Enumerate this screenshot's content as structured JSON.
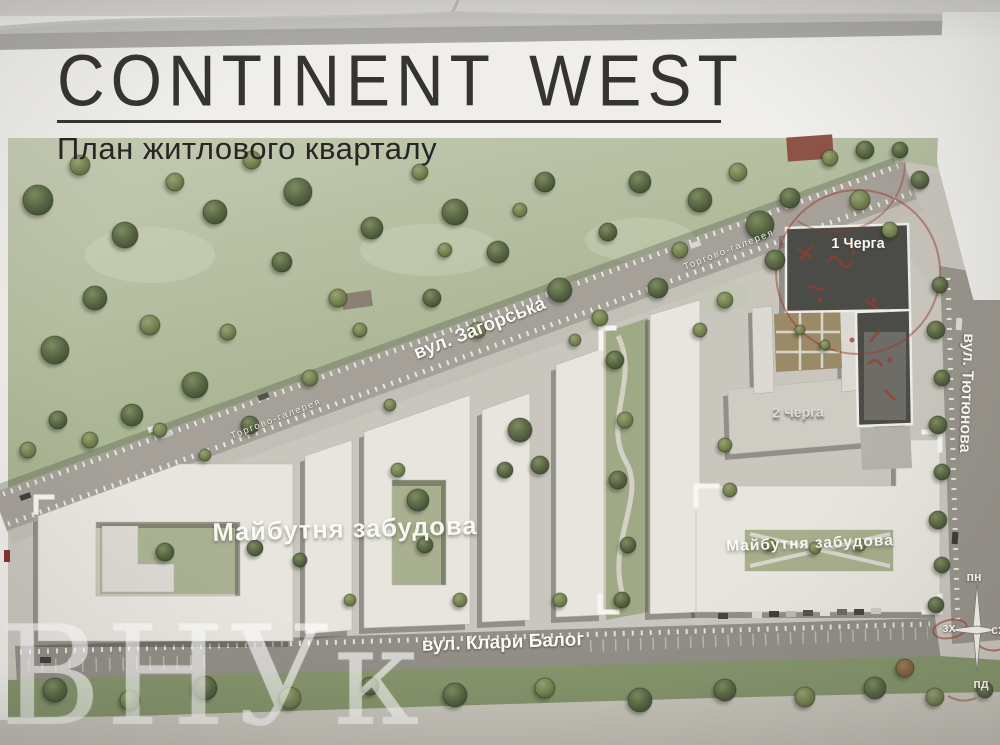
{
  "header": {
    "logo": "CONTINENT WEST",
    "subtitle": "План житлового кварталу"
  },
  "map": {
    "streets": {
      "zahorska": "вул. Загорська",
      "tyutyunova": "вул. Тютюнова",
      "klary_baloh": "вул. Клари Балог"
    },
    "galleries": {
      "first": "Торгово-галерея",
      "second": "Торгово-галерея"
    },
    "phases": {
      "phase1": "1 Черга",
      "phase2": "2 Черга"
    },
    "future": {
      "left": "Майбутня забудова",
      "right": "Майбутня забудова"
    },
    "compass": {
      "n": "пн",
      "w": "зх",
      "s": "пд",
      "e": "сх"
    }
  },
  "watermark": "ВНУк",
  "colors": {
    "park_green": "#aab394",
    "road_gray": "#a39f97",
    "building_white": "#e7e5de",
    "phase1_dark": "#4b4b48",
    "red_marker": "#9c3a2c"
  }
}
